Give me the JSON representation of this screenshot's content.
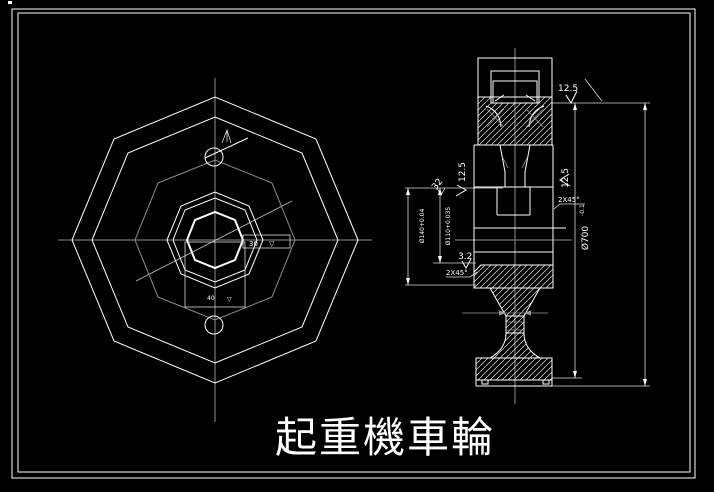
{
  "drawing": {
    "background": "#000000",
    "stroke_color": "#ffffff",
    "centerline_color": "#8f8f8f",
    "title_text": "起重機車輪"
  },
  "front_view": {
    "bore_dim_label": "30",
    "bore_dim_symbol": "▽",
    "keyway_dim_label": "40",
    "keyway_dim_symbol": "▽"
  },
  "section_view": {
    "roughness_top": "12.5",
    "roughness_left": "12.5",
    "roughness_right": "12.5",
    "roughness_hub_face": "3.2",
    "dim_width": "32",
    "chamfer_left": "2X45°",
    "chamfer_right": "2X45°",
    "dim_outer_diameter": "Ø700",
    "dim_outer_tolerance": "-0.1",
    "dim_bore_left": "Ø140+0.04",
    "dim_bore_right": "Ø110+0.035"
  }
}
